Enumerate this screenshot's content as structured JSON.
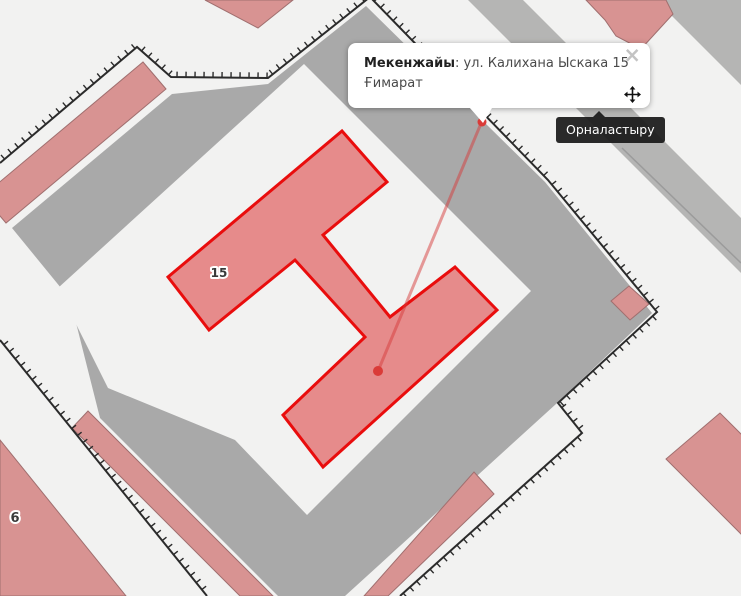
{
  "popup": {
    "label": "Мекенжайы",
    "separator": ": ",
    "street": "ул. Калихана Ыскака 15",
    "line2": "Ғимарат",
    "close_glyph": "×"
  },
  "tooltip": {
    "text": "Орналастыру"
  },
  "colors": {
    "bg": "#f2f2f1",
    "gray": "#a9a9a9",
    "grayLight": "#b5b5b4",
    "pinkFill": "#d89392",
    "pinkStroke": "#a06f6f",
    "selectedFill": "#e68b8b",
    "selectedStroke": "#e90d0d",
    "boundary": "#2b2b2b",
    "leader": "rgba(214,60,60,0.5)",
    "dotRed": "#da3b38",
    "label": "#3a3a3a",
    "divider": "#9b9b9b"
  },
  "map": {
    "width": 741,
    "height": 596,
    "features": [
      {
        "name": "block-area",
        "type": "polygon",
        "interactable": false,
        "fill": "gray",
        "points": [
          [
            172,
            94
          ],
          [
            268,
            84
          ],
          [
            366,
            6
          ],
          [
            545,
            182
          ],
          [
            652,
            313
          ],
          [
            556,
            404
          ],
          [
            345,
            596
          ],
          [
            278,
            596
          ],
          [
            100,
            418
          ],
          [
            70,
            299
          ],
          [
            12,
            228
          ]
        ]
      },
      {
        "name": "road-band-northeast",
        "type": "polygon",
        "interactable": false,
        "fill": "grayLight",
        "points": [
          [
            468,
            0
          ],
          [
            523,
            0
          ],
          [
            741,
            218
          ],
          [
            741,
            273
          ]
        ]
      },
      {
        "name": "road-band-corner",
        "type": "polygon",
        "interactable": false,
        "fill": "grayLight",
        "points": [
          [
            656,
            0
          ],
          [
            741,
            0
          ],
          [
            741,
            85
          ]
        ]
      },
      {
        "name": "road-divider-line",
        "type": "polyline",
        "interactable": false,
        "stroke": "divider",
        "width": 1.5,
        "points": [
          [
            622,
            148
          ],
          [
            741,
            263
          ]
        ]
      },
      {
        "name": "courtyard",
        "type": "polygon",
        "interactable": false,
        "fill": "bg",
        "points": [
          [
            304,
            64
          ],
          [
            531,
            291
          ],
          [
            307,
            515
          ],
          [
            235,
            440
          ],
          [
            108,
            388
          ],
          [
            58,
            288
          ]
        ]
      },
      {
        "name": "building-strip-northwest",
        "type": "polygon",
        "interactable": true,
        "fill": "pinkFill",
        "stroke": "pinkStroke",
        "width": 1,
        "points": [
          [
            143,
            62
          ],
          [
            166,
            89
          ],
          [
            6,
            223
          ],
          [
            -17,
            196
          ]
        ]
      },
      {
        "name": "building-top-triangle",
        "type": "polygon",
        "interactable": true,
        "fill": "pinkFill",
        "stroke": "pinkStroke",
        "width": 1,
        "points": [
          [
            205,
            0
          ],
          [
            293,
            0
          ],
          [
            258,
            28
          ]
        ]
      },
      {
        "name": "building-northeast",
        "type": "polygon",
        "interactable": true,
        "fill": "pinkFill",
        "stroke": "pinkStroke",
        "width": 1,
        "points": [
          [
            586,
            0
          ],
          [
            666,
            0
          ],
          [
            673,
            14
          ],
          [
            641,
            49
          ],
          [
            616,
            36
          ],
          [
            605,
            20
          ]
        ]
      },
      {
        "name": "building-small-square",
        "type": "polygon",
        "interactable": true,
        "fill": "pinkFill",
        "stroke": "pinkStroke",
        "width": 1,
        "points": [
          [
            629,
            286
          ],
          [
            649,
            304
          ],
          [
            630,
            320
          ],
          [
            611,
            301
          ]
        ]
      },
      {
        "name": "building-southeast",
        "type": "polygon",
        "interactable": true,
        "fill": "pinkFill",
        "stroke": "pinkStroke",
        "width": 1,
        "points": [
          [
            720,
            413
          ],
          [
            666,
            459
          ],
          [
            746,
            539
          ],
          [
            800,
            493
          ]
        ]
      },
      {
        "name": "building-strip-b",
        "type": "polygon",
        "interactable": true,
        "fill": "pinkFill",
        "stroke": "pinkStroke",
        "width": 1,
        "points": [
          [
            88,
            411
          ],
          [
            72,
            428
          ],
          [
            240,
            596
          ],
          [
            273,
            596
          ]
        ]
      },
      {
        "name": "building-strip-c",
        "type": "polygon",
        "interactable": true,
        "fill": "pinkFill",
        "stroke": "pinkStroke",
        "width": 1,
        "points": [
          [
            474,
            472
          ],
          [
            494,
            494
          ],
          [
            388,
            596
          ],
          [
            364,
            596
          ]
        ]
      },
      {
        "name": "building-6",
        "type": "polygon",
        "interactable": true,
        "fill": "pinkFill",
        "stroke": "pinkStroke",
        "width": 1,
        "points": [
          [
            0,
            440
          ],
          [
            126,
            596
          ],
          [
            0,
            596
          ]
        ]
      },
      {
        "name": "parcel-boundary-main",
        "type": "boundary",
        "interactable": false,
        "stroke": "boundary",
        "width": 2,
        "points": [
          [
            0,
            163
          ],
          [
            137,
            47
          ],
          [
            171,
            77
          ],
          [
            268,
            78
          ],
          [
            370,
            -3
          ],
          [
            548,
            180
          ],
          [
            657,
            312
          ],
          [
            558,
            403
          ],
          [
            582,
            433
          ],
          [
            400,
            596
          ]
        ]
      },
      {
        "name": "parcel-boundary-southwest",
        "type": "boundary",
        "interactable": false,
        "stroke": "boundary",
        "width": 2,
        "points": [
          [
            0,
            340
          ],
          [
            207,
            596
          ]
        ]
      },
      {
        "name": "selected-building",
        "type": "polygon",
        "interactable": true,
        "fill": "selectedFill",
        "stroke": "selectedStroke",
        "width": 3,
        "points": [
          [
            342,
            131
          ],
          [
            387,
            182
          ],
          [
            323,
            235
          ],
          [
            390,
            317
          ],
          [
            455,
            267
          ],
          [
            497,
            310
          ],
          [
            323,
            467
          ],
          [
            283,
            415
          ],
          [
            365,
            337
          ],
          [
            295,
            260
          ],
          [
            209,
            330
          ],
          [
            168,
            277
          ]
        ]
      },
      {
        "name": "leader-line",
        "type": "polyline",
        "interactable": false,
        "stroke": "leader",
        "width": 3,
        "points": [
          [
            482,
            121
          ],
          [
            378,
            371
          ]
        ]
      },
      {
        "name": "anchor-dot-popup",
        "type": "circle",
        "interactable": false,
        "fill": "dotRed",
        "cx": 482,
        "cy": 122,
        "r": 4.5
      },
      {
        "name": "anchor-dot-building",
        "type": "circle",
        "interactable": true,
        "fill": "dotRed",
        "cx": 378,
        "cy": 371,
        "r": 5
      },
      {
        "name": "building-number-15",
        "type": "label",
        "interactable": false,
        "text": "15",
        "x": 219,
        "y": 277,
        "size": 12
      },
      {
        "name": "building-number-6",
        "type": "label",
        "interactable": false,
        "text": "6",
        "x": 15,
        "y": 522,
        "size": 13
      }
    ]
  }
}
